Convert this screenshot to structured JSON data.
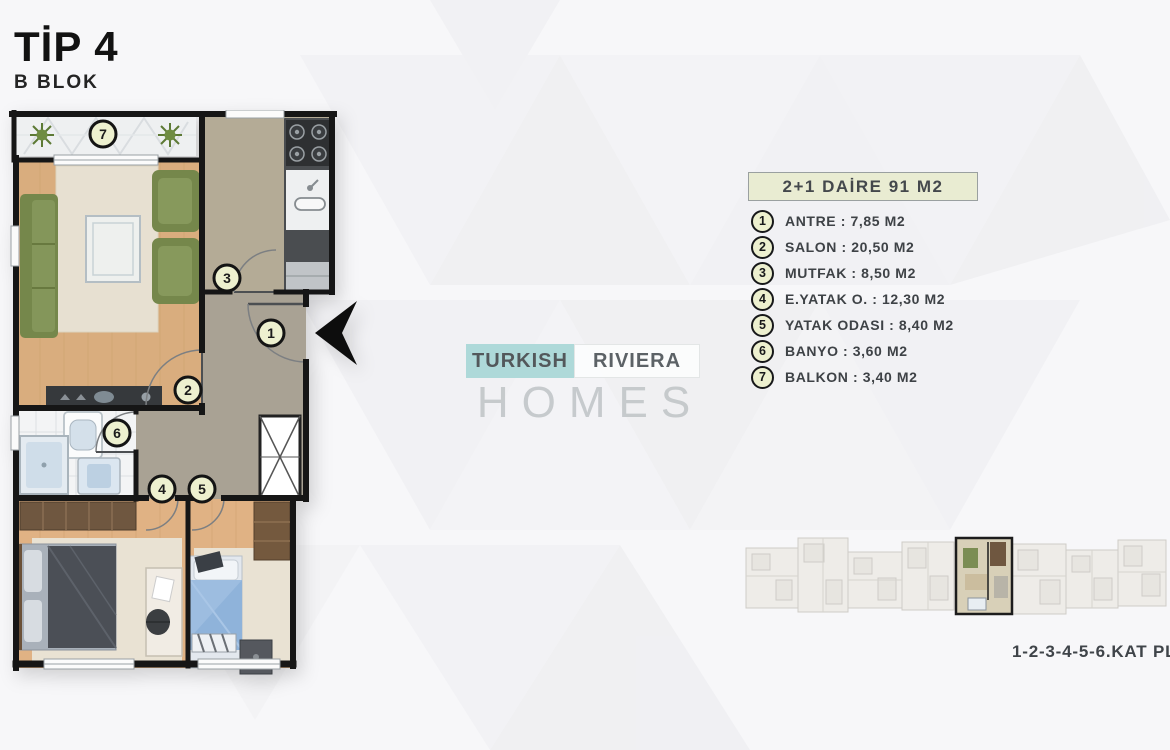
{
  "page": {
    "title": "TİP 4",
    "subtitle": "B BLOK"
  },
  "legend": {
    "header": "2+1 DAİRE 91 M2",
    "items": [
      {
        "num": "1",
        "label": "ANTRE : 7,85 M2"
      },
      {
        "num": "2",
        "label": "SALON : 20,50 M2"
      },
      {
        "num": "3",
        "label": "MUTFAK : 8,50 M2"
      },
      {
        "num": "4",
        "label": "E.YATAK O. : 12,30 M2"
      },
      {
        "num": "5",
        "label": "YATAK ODASI : 8,40 M2"
      },
      {
        "num": "6",
        "label": "BANYO : 3,60 M2"
      },
      {
        "num": "7",
        "label": "BALKON : 3,40 M2"
      }
    ]
  },
  "floorplan": {
    "numbers": {
      "antre": "1",
      "salon": "2",
      "mutfak": "3",
      "eyatak": "4",
      "yatak": "5",
      "banyo": "6",
      "balkon": "7"
    }
  },
  "watermark": {
    "turkish": "TURKISH",
    "riviera": "RIVIERA",
    "homes": "HOMES"
  },
  "keyplan": {
    "caption": "1-2-3-4-5-6.KAT PLANI"
  },
  "colors": {
    "accent_teal": "#aed9d9",
    "legend_bg": "#e9ecd2",
    "wall": "#161616",
    "wood_floor": "#d9ad7e",
    "sofa_green": "#75874b"
  }
}
